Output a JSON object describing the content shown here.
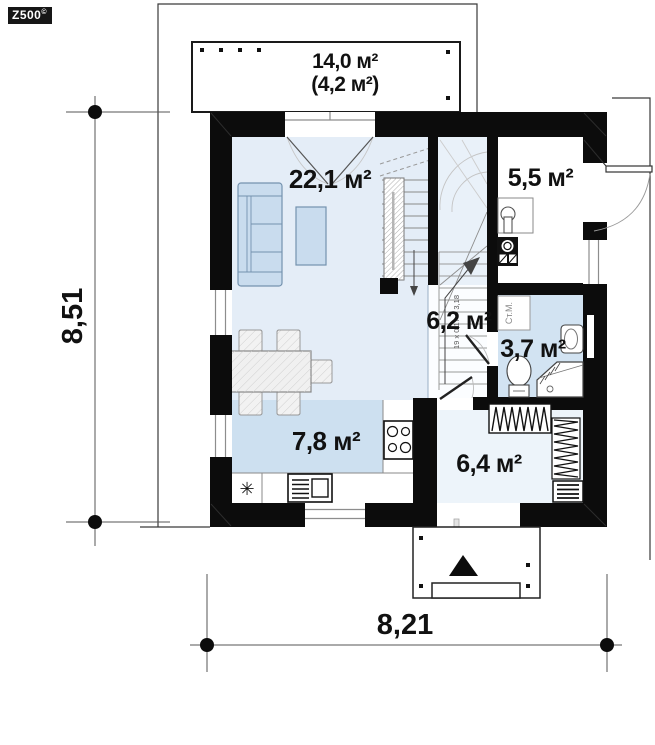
{
  "logo": {
    "text": "Z500",
    "sup": "©"
  },
  "rooms": {
    "terrace": {
      "area": "14,0 м²",
      "area_secondary": "(4,2 м²)"
    },
    "living": {
      "area": "22,1 м²"
    },
    "boiler": {
      "area": "5,5 м²"
    },
    "hall": {
      "area": "6,2 м²"
    },
    "bathroom": {
      "area": "3,7 м²"
    },
    "kitchen": {
      "area": "7,8 м²"
    },
    "entry": {
      "area": "6,4 м²"
    }
  },
  "dimensions": {
    "overall_width_m": "8,21",
    "overall_height_m": "8,51"
  },
  "annotations": {
    "washing_machine": "Ст.М.",
    "stair_formula": "19 x 0,17 = 3,18",
    "fridge_symbol": "✳"
  },
  "colors": {
    "wall": "#0c0c0c",
    "living_fill": "#e4edf7",
    "stairwell_fill": "#e9f1f9",
    "kitchen_fill": "#cde0f0",
    "bathroom_fill": "#d2e3f2",
    "entry_fill": "#edf4fa",
    "furniture_blue": "#c9dcee"
  }
}
